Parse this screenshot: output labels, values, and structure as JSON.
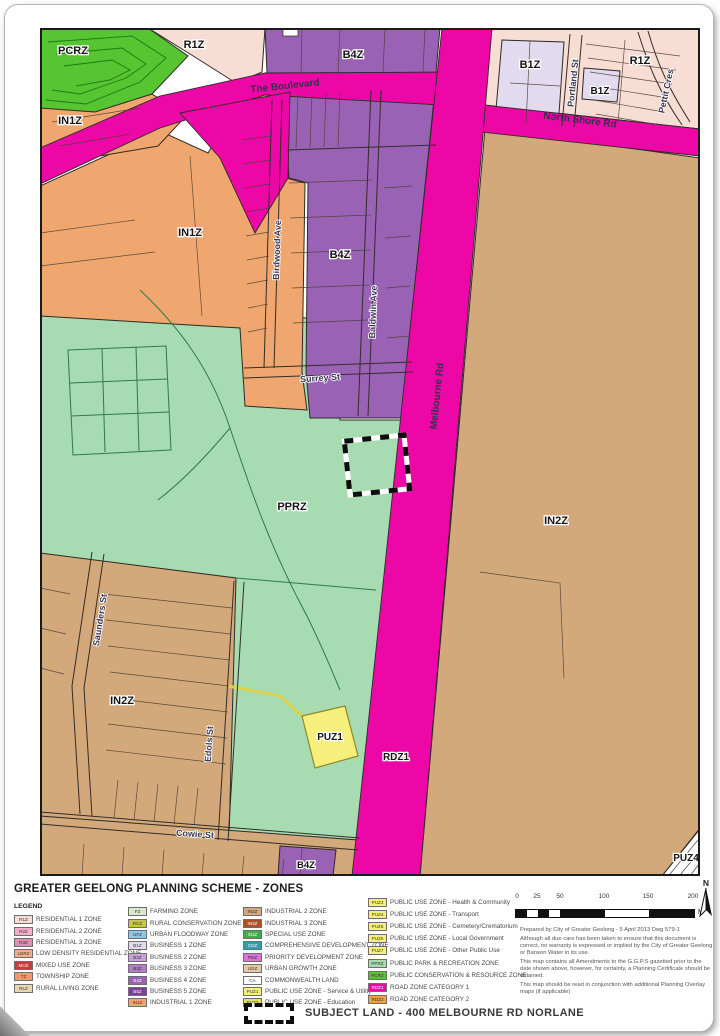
{
  "page": {
    "title": "GREATER GEELONG PLANNING SCHEME - ZONES",
    "legend_heading": "LEGEND"
  },
  "palette": {
    "road": "#EE07A7",
    "b4z": "#9A62B4",
    "b1z": "#E2DAEF",
    "r1z": "#F7DDD3",
    "in1z": "#F0A76F",
    "in2z": "#D3A87B",
    "pprz": "#A7DBB1",
    "pcrz": "#56C531",
    "puz": "#F6EF7B",
    "white": "#FFFFFF"
  },
  "map": {
    "zones": {
      "pcrz": "PCRZ",
      "r1z_nw": "R1Z",
      "b4z_top": "B4Z",
      "b1z_main": "B1Z",
      "b1z_small": "B1Z",
      "r1z_ne": "R1Z",
      "in1z_nw": "IN1Z",
      "in1z_main": "IN1Z",
      "b4z_mid": "B4Z",
      "in2z_east": "IN2Z",
      "pprz": "PPRZ",
      "in2z_west": "IN2Z",
      "puz1": "PUZ1",
      "rdz1": "RDZ1",
      "b4z_south": "B4Z",
      "puz4": "PUZ4"
    },
    "streets": {
      "boulevard": "The Boulevard",
      "northshore": "North Shore  Rd",
      "melbourne": "Melbourne  Rd",
      "portland": "Portland St",
      "pettit": "Pettit  Cres",
      "birdwood": "Birdwood  Ave",
      "baldwin": "Baldwin  Ave",
      "surrey": "Surrey  St",
      "saunders": "Saunders  St",
      "edols": "Edols  St",
      "cowie": "Cowie  St"
    }
  },
  "legend": {
    "cols": [
      [
        {
          "c": "R1Z",
          "l": "RESIDENTIAL 1 ZONE",
          "col": "#F7DDD3"
        },
        {
          "c": "R2Z",
          "l": "RESIDENTIAL 2 ZONE",
          "col": "#F2AECB"
        },
        {
          "c": "R3Z",
          "l": "RESIDENTIAL 3 ZONE",
          "col": "#E58CB4"
        },
        {
          "c": "LDRZ",
          "l": "LOW DENSITY RESIDENTIAL ZONE",
          "col": "#F0B088"
        },
        {
          "c": "MUZ",
          "l": "MIXED USE ZONE",
          "col": "#CE3B38"
        },
        {
          "c": "TZ",
          "l": "TOWNSHIP ZONE",
          "col": "#EE9A6A"
        },
        {
          "c": "RLZ",
          "l": "RURAL LIVING ZONE",
          "col": "#E9D7AE"
        }
      ],
      [
        {
          "c": "FZ",
          "l": "FARMING ZONE",
          "col": "#D7EBCB"
        },
        {
          "c": "RCZ",
          "l": "RURAL CONSERVATION ZONE",
          "col": "#C5C93B"
        },
        {
          "c": "UFZ",
          "l": "URBAN FLOODWAY ZONE",
          "col": "#92C6E8"
        },
        {
          "c": "B1Z",
          "l": "BUSINESS 1 ZONE",
          "col": "#E2DAEF"
        },
        {
          "c": "B2Z",
          "l": "BUSINESS 2 ZONE",
          "col": "#C9A0D8"
        },
        {
          "c": "B3Z",
          "l": "BUSINESS 3 ZONE",
          "col": "#B57FC6"
        },
        {
          "c": "B4Z",
          "l": "BUSINESS 4 ZONE",
          "col": "#9A62B4"
        },
        {
          "c": "B5Z",
          "l": "BUSINESS 5 ZONE",
          "col": "#7B3FA0"
        },
        {
          "c": "IN1Z",
          "l": "INDUSTRIAL 1 ZONE",
          "col": "#F0A76F"
        }
      ],
      [
        {
          "c": "IN2Z",
          "l": "INDUSTRIAL 2 ZONE",
          "col": "#D3A87B"
        },
        {
          "c": "IN3Z",
          "l": "INDUSTRIAL 3 ZONE",
          "col": "#AE4F26"
        },
        {
          "c": "SUZ",
          "l": "SPECIAL USE ZONE",
          "col": "#44AC49"
        },
        {
          "c": "CDZ",
          "l": "COMPREHENSIVE DEVELOPMENT ZONE",
          "col": "#2F9FA8"
        },
        {
          "c": "PDZ",
          "l": "PRIORITY DEVELOPMENT ZONE",
          "col": "#DC73D4"
        },
        {
          "c": "UGZ",
          "l": "URBAN GROWTH ZONE",
          "col": "#E5C9A4"
        },
        {
          "c": "CA",
          "l": "COMMONWEALTH LAND",
          "col": "#FFFFFF"
        },
        {
          "c": "PUZ1",
          "l": "PUBLIC USE ZONE  - Service & Utility",
          "col": "#F6EF7B"
        },
        {
          "c": "PUZ2",
          "l": "PUBLIC USE ZONE  - Education",
          "col": "#DEE45F"
        }
      ],
      [
        {
          "c": "PUZ3",
          "l": "PUBLIC USE ZONE  - Health & Community",
          "col": "#F6EF7B"
        },
        {
          "c": "PUZ4",
          "l": "PUBLIC USE ZONE  - Transport",
          "col": "#F6EF7B"
        },
        {
          "c": "PUZ5",
          "l": "PUBLIC USE ZONE  - Cemetery/Crematorium",
          "col": "#F6EF7B"
        },
        {
          "c": "PUZ6",
          "l": "PUBLIC USE ZONE  - Local Government",
          "col": "#F6EF7B"
        },
        {
          "c": "PUZ7",
          "l": "PUBLIC USE ZONE  - Other Public Use",
          "col": "#F6EF7B"
        },
        {
          "c": "PPRZ",
          "l": "PUBLIC PARK & RECREATION ZONE",
          "col": "#A7DBB1"
        },
        {
          "c": "PCRZ",
          "l": "PUBLIC CONSERVATION & RESOURCE ZONE",
          "col": "#56C531"
        },
        {
          "c": "RDZ1",
          "l": "ROAD ZONE CATEGORY 1",
          "col": "#EE07A7"
        },
        {
          "c": "RDZ2",
          "l": "ROAD ZONE CATEGORY 2",
          "col": "#F2A237"
        }
      ]
    ]
  },
  "scale": {
    "ticks": [
      "0",
      "25",
      "50",
      "100",
      "150",
      "200"
    ],
    "unit": "M"
  },
  "compass": {
    "label": "N"
  },
  "notes": [
    "Prepared by City of Greater Geelong - 5 April 2013  Dwg 579-1",
    "Although all due care has been taken to ensure that this document is correct, no warranty is expressed or implied by the City of Greater Geelong or Barwon Water in its use.",
    "This map contains all Amendments to the G.G.P.S gazetted prior to the date shown above, however, for certainty, a Planning Certificate should be obtained.",
    "This map should be read in conjunction with additional Planning Overlay maps (if applicable)"
  ],
  "subject": {
    "label": "SUBJECT LAND - 400 MELBOURNE RD NORLANE"
  }
}
